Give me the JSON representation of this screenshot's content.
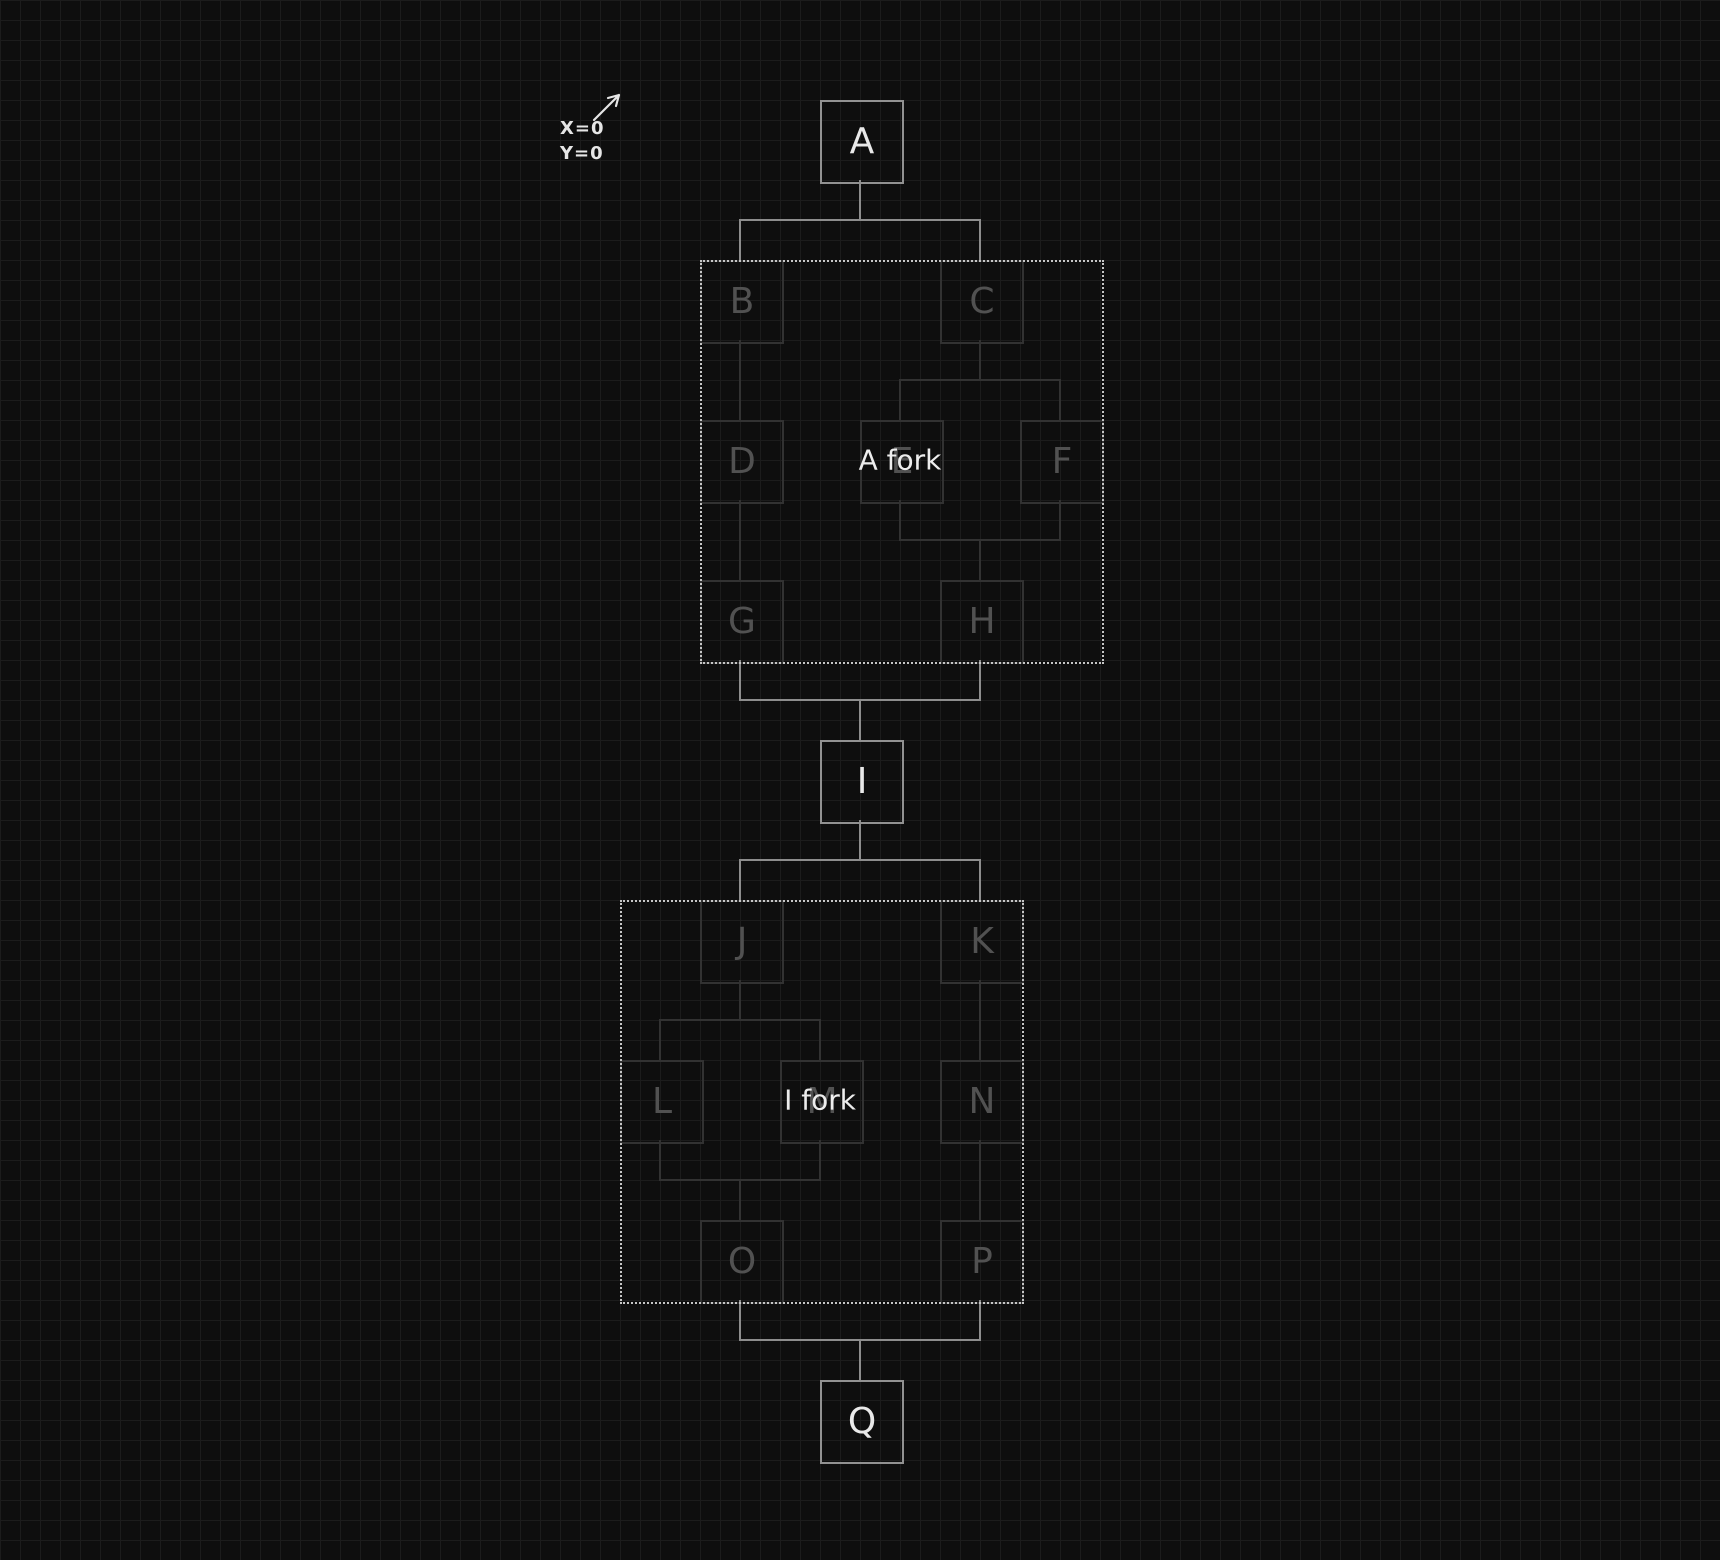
{
  "canvas": {
    "width": 1720,
    "height": 1560,
    "background_color": "#0e0e0e",
    "grid_color": "#1c1c1c",
    "grid_size": 20
  },
  "annotation": {
    "x_label": "X=0",
    "y_label": "Y=0",
    "arrow_icon": "arrow-up-right"
  },
  "colors": {
    "bright_stroke": "#929292",
    "bright_text": "#e9e9e9",
    "dim_stroke": "#323232",
    "dim_text": "#515151",
    "group_border": "#c6c6c6",
    "group_label_text": "#ededed",
    "edge_bright": "#8d8d8d",
    "edge_dim": "#323232"
  },
  "diagram": {
    "node_size": 80,
    "nodes": [
      {
        "id": "A",
        "x": 820,
        "y": 100,
        "tone": "bright"
      },
      {
        "id": "B",
        "x": 700,
        "y": 260,
        "tone": "dim"
      },
      {
        "id": "C",
        "x": 940,
        "y": 260,
        "tone": "dim"
      },
      {
        "id": "D",
        "x": 700,
        "y": 420,
        "tone": "dim"
      },
      {
        "id": "E",
        "x": 860,
        "y": 420,
        "tone": "dim"
      },
      {
        "id": "F",
        "x": 1020,
        "y": 420,
        "tone": "dim"
      },
      {
        "id": "G",
        "x": 700,
        "y": 580,
        "tone": "dim"
      },
      {
        "id": "H",
        "x": 940,
        "y": 580,
        "tone": "dim"
      },
      {
        "id": "I",
        "x": 820,
        "y": 740,
        "tone": "bright"
      },
      {
        "id": "J",
        "x": 700,
        "y": 900,
        "tone": "dim"
      },
      {
        "id": "K",
        "x": 940,
        "y": 900,
        "tone": "dim"
      },
      {
        "id": "L",
        "x": 620,
        "y": 1060,
        "tone": "dim"
      },
      {
        "id": "M",
        "x": 780,
        "y": 1060,
        "tone": "dim"
      },
      {
        "id": "N",
        "x": 940,
        "y": 1060,
        "tone": "dim"
      },
      {
        "id": "O",
        "x": 700,
        "y": 1220,
        "tone": "dim"
      },
      {
        "id": "P",
        "x": 940,
        "y": 1220,
        "tone": "dim"
      },
      {
        "id": "Q",
        "x": 820,
        "y": 1380,
        "tone": "bright"
      }
    ],
    "groups": [
      {
        "label": "A fork",
        "x": 700,
        "y": 260,
        "width": 400,
        "height": 400,
        "label_anchor": "E"
      },
      {
        "label": "I fork",
        "x": 620,
        "y": 900,
        "width": 400,
        "height": 400,
        "label_anchor": "M"
      }
    ],
    "edges": [
      {
        "from": [
          "A"
        ],
        "to": [
          "B",
          "C"
        ],
        "tone": "bright"
      },
      {
        "from": [
          "B"
        ],
        "to": [
          "D"
        ],
        "tone": "dim"
      },
      {
        "from": [
          "C"
        ],
        "to": [
          "E",
          "F"
        ],
        "tone": "dim"
      },
      {
        "from": [
          "D"
        ],
        "to": [
          "G"
        ],
        "tone": "dim"
      },
      {
        "from": [
          "E",
          "F"
        ],
        "to": [
          "H"
        ],
        "tone": "dim"
      },
      {
        "from": [
          "G",
          "H"
        ],
        "to": [
          "I"
        ],
        "tone": "bright"
      },
      {
        "from": [
          "I"
        ],
        "to": [
          "J",
          "K"
        ],
        "tone": "bright"
      },
      {
        "from": [
          "J"
        ],
        "to": [
          "L",
          "M"
        ],
        "tone": "dim"
      },
      {
        "from": [
          "K"
        ],
        "to": [
          "N"
        ],
        "tone": "dim"
      },
      {
        "from": [
          "L",
          "M"
        ],
        "to": [
          "O"
        ],
        "tone": "dim"
      },
      {
        "from": [
          "N"
        ],
        "to": [
          "P"
        ],
        "tone": "dim"
      },
      {
        "from": [
          "O",
          "P"
        ],
        "to": [
          "Q"
        ],
        "tone": "bright"
      }
    ]
  }
}
